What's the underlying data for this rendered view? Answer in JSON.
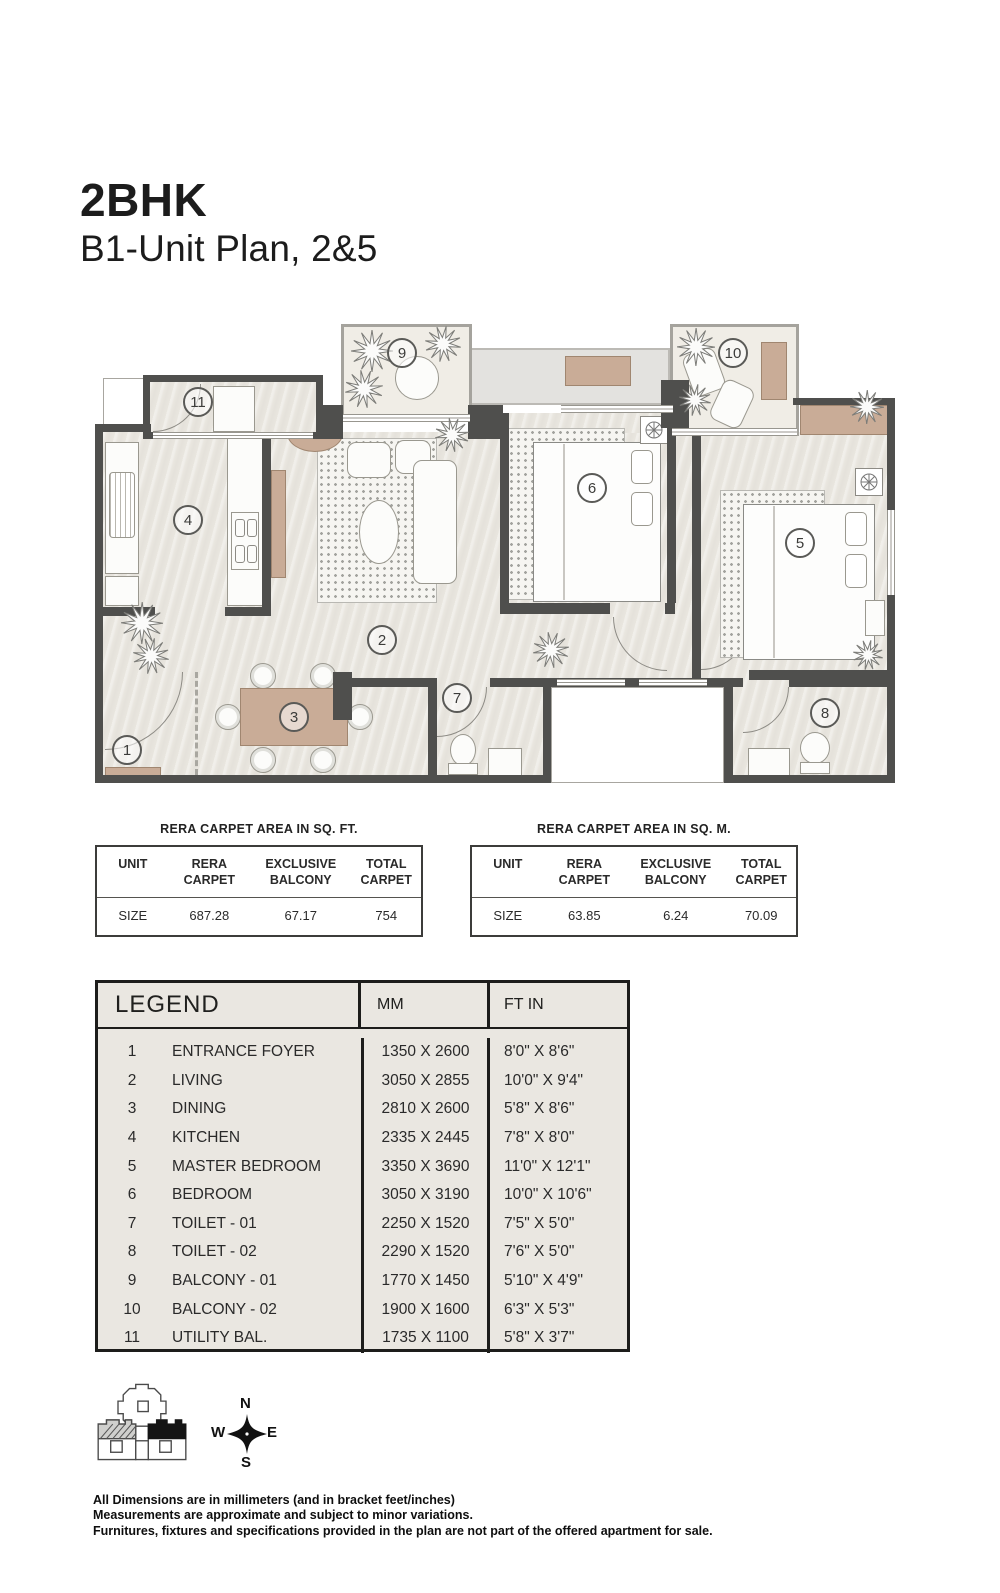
{
  "page": {
    "title": "2BHK",
    "subtitle": "B1-Unit Plan, 2&5"
  },
  "area_tables": [
    {
      "title": "RERA CARPET AREA IN SQ. FT.",
      "headers": [
        "UNIT",
        "RERA CARPET",
        "EXCLUSIVE BALCONY",
        "TOTAL CARPET"
      ],
      "row": [
        "SIZE",
        "687.28",
        "67.17",
        "754"
      ]
    },
    {
      "title": "RERA CARPET AREA IN SQ. M.",
      "headers": [
        "UNIT",
        "RERA CARPET",
        "EXCLUSIVE BALCONY",
        "TOTAL CARPET"
      ],
      "row": [
        "SIZE",
        "63.85",
        "6.24",
        "70.09"
      ]
    }
  ],
  "legend": {
    "title": "LEGEND",
    "col_mm": "MM",
    "col_ftin": "FT IN",
    "rows": [
      {
        "no": "1",
        "name": "ENTRANCE FOYER",
        "mm": "1350 X 2600",
        "ftin": "8'0\" X 8'6\""
      },
      {
        "no": "2",
        "name": "LIVING",
        "mm": "3050 X 2855",
        "ftin": "10'0\" X 9'4\""
      },
      {
        "no": "3",
        "name": "DINING",
        "mm": "2810 X 2600",
        "ftin": "5'8\" X 8'6\""
      },
      {
        "no": "4",
        "name": "KITCHEN",
        "mm": "2335 X 2445",
        "ftin": "7'8\" X 8'0\""
      },
      {
        "no": "5",
        "name": "MASTER BEDROOM",
        "mm": "3350 X 3690",
        "ftin": "11'0\" X 12'1\""
      },
      {
        "no": "6",
        "name": "BEDROOM",
        "mm": "3050 X 3190",
        "ftin": "10'0\" X 10'6\""
      },
      {
        "no": "7",
        "name": "TOILET - 01",
        "mm": "2250 X 1520",
        "ftin": "7'5\" X 5'0\""
      },
      {
        "no": "8",
        "name": "TOILET - 02",
        "mm": "2290 X 1520",
        "ftin": "7'6\" X 5'0\""
      },
      {
        "no": "9",
        "name": "BALCONY - 01",
        "mm": "1770 X 1450",
        "ftin": "5'10\" X 4'9\""
      },
      {
        "no": "10",
        "name": "BALCONY - 02",
        "mm": "1900 X 1600",
        "ftin": "6'3\" X 5'3\""
      },
      {
        "no": "11",
        "name": "UTILITY BAL.",
        "mm": "1735 X 1100",
        "ftin": "5'8\" X 3'7\""
      }
    ]
  },
  "plan": {
    "room_numbers": [
      "1",
      "2",
      "3",
      "4",
      "5",
      "6",
      "7",
      "8",
      "9",
      "10",
      "11"
    ]
  },
  "compass": {
    "n": "N",
    "e": "E",
    "s": "S",
    "w": "W"
  },
  "footer": {
    "lines": [
      "All Dimensions are in millimeters (and in bracket feet/inches)",
      "Measurements are approximate and subject to minor variations.",
      "Furnitures, fixtures and specifications provided in the plan are not part of the offered apartment for sale."
    ]
  },
  "colors": {
    "wall": "#4f4f4d",
    "floor": "#e9e6df",
    "balcony": "#f0ede6",
    "furniture_tan": "#c9ac97",
    "rug_dot": "#a3a39e"
  }
}
